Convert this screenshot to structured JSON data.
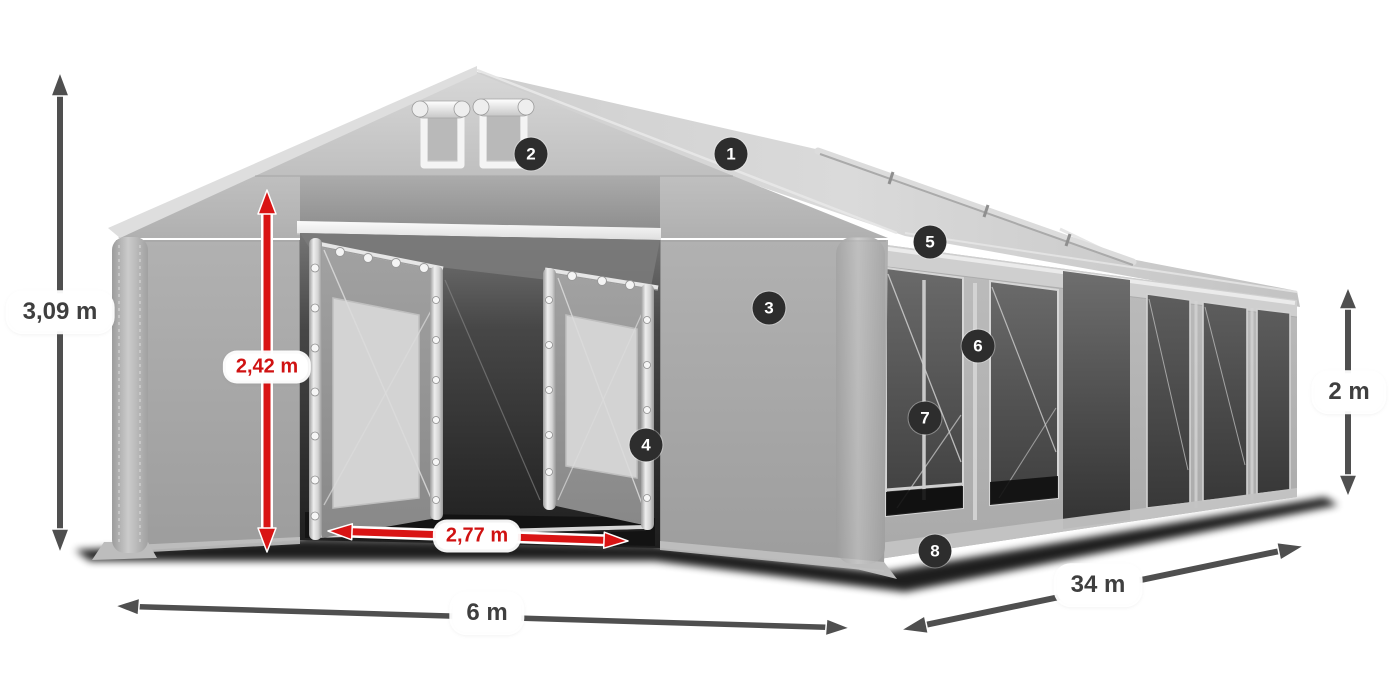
{
  "dimension_labels": {
    "total_height": "3,09 m",
    "entrance_height": "2,42 m",
    "entrance_width": "2,77 m",
    "width": "6 m",
    "length": "34 m",
    "side_wall_height": "2 m"
  },
  "callout_badges": [
    "1",
    "2",
    "3",
    "4",
    "5",
    "6",
    "7",
    "8"
  ],
  "colors": {
    "background": "#ffffff",
    "dimension_arrow_gray": "#4f4f4f",
    "dimension_arrow_red": "#d91414",
    "label_text_dark": "#3f3f3f",
    "label_text_red": "#d01212",
    "badge_background": "#2d2d2d",
    "badge_text": "#ffffff",
    "tent_fabric": "#b5b5b5",
    "tent_roof": "#cdcdcd"
  }
}
